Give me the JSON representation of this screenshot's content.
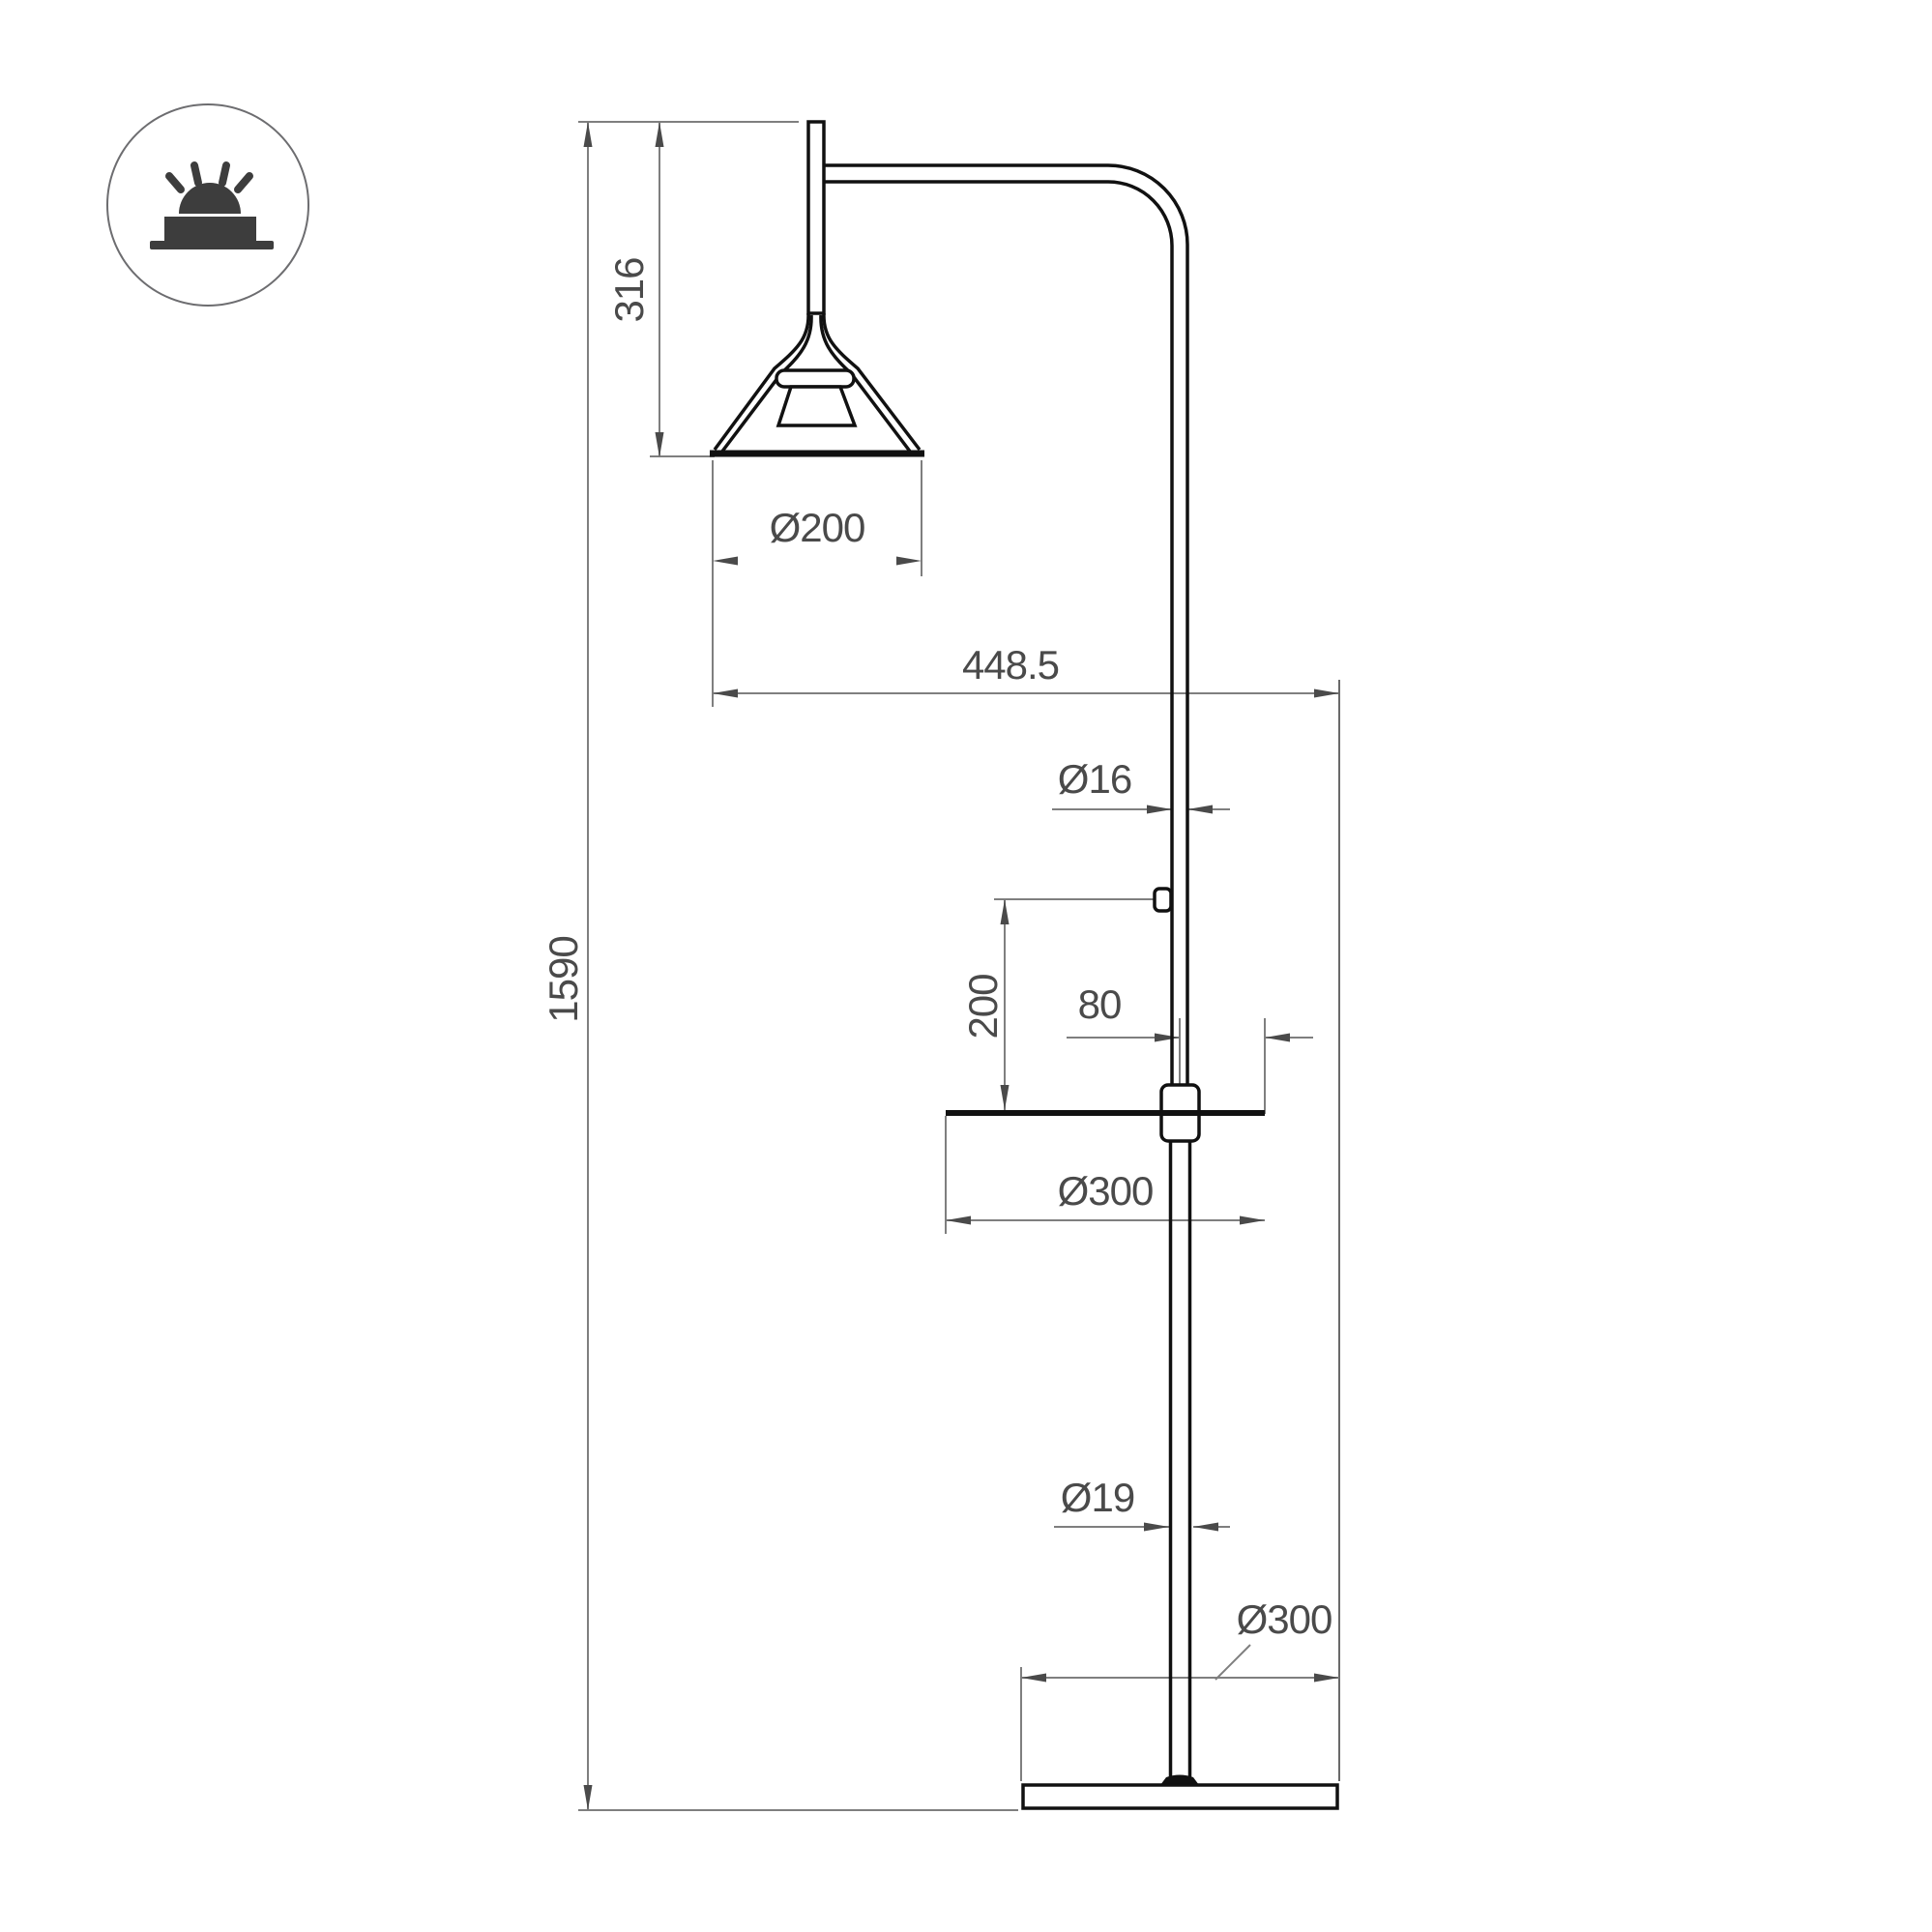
{
  "drawing": {
    "icon": {
      "symbol": "recessed-downlight"
    },
    "labels": {
      "shade_height": "316",
      "total_height": "1590",
      "shade_diameter": "Ø200",
      "arm_reach": "448.5",
      "pole_diameter": "Ø16",
      "switch_height_above_table": "200",
      "table_edge_offset": "80",
      "table_diameter": "Ø300",
      "lower_pole_diameter": "Ø19",
      "base_diameter": "Ø300"
    },
    "colors": {
      "line": "#111111",
      "dim-line": "#7f7f7f",
      "dim-text": "#4a4a4a",
      "icon": "#3d3d3d",
      "bg": "#ffffff"
    }
  }
}
